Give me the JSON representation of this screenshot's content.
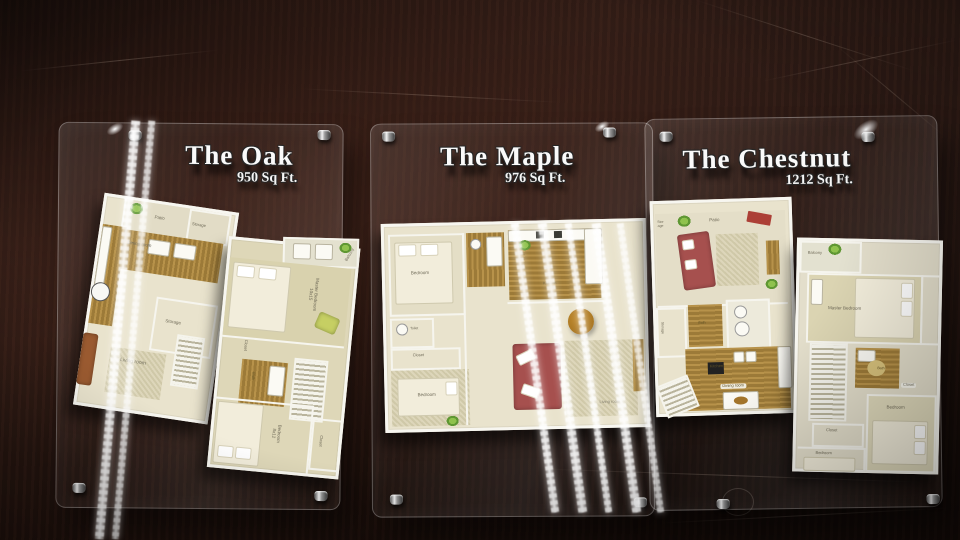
{
  "panels": [
    {
      "title": "The Oak",
      "sqft": "950 Sq Ft.",
      "floors": [
        {
          "rooms": [
            "Patio",
            "Storage",
            "Dining room",
            "Storage",
            "Living room"
          ]
        },
        {
          "rooms": [
            "Balcony",
            "Master Bedroom\n10x15",
            "Closet",
            "Bath",
            "Bedroom\n8x12",
            "Closet"
          ]
        }
      ]
    },
    {
      "title": "The Maple",
      "sqft": "976 Sq Ft.",
      "floors": [
        {
          "rooms": [
            "Bedroom",
            "Toilet",
            "Closet",
            "Bedroom",
            "Kitchen",
            "Living room"
          ]
        }
      ]
    },
    {
      "title": "The Chestnut",
      "sqft": "1212 Sq Ft.",
      "floors": [
        {
          "rooms": [
            "Stor\nage",
            "Patio",
            "Storage",
            "Bath",
            "Kitchen",
            "Dining room"
          ]
        },
        {
          "rooms": [
            "Balcony",
            "Master Bedroom",
            "Bath",
            "Closet",
            "Closet",
            "Bedroom",
            "Bedroom"
          ]
        }
      ]
    }
  ],
  "colors": {
    "table_wood": "#2b1913",
    "plan_cream": "#e9e3cd",
    "plan_wood": "#ab8440",
    "sofa_red": "#a6504e",
    "plant_green": "#7fb743",
    "title_text": "#fafafa"
  }
}
